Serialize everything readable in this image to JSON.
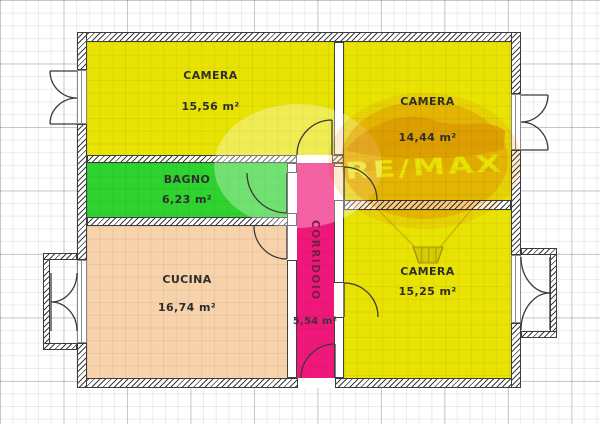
{
  "watermark": {
    "brand": "RE/MAX"
  },
  "rooms": {
    "camera1": {
      "label": "CAMERA",
      "area": "15,56 m²",
      "color": "#e9e304"
    },
    "camera2": {
      "label": "CAMERA",
      "area": "14,44 m²",
      "color": "#e9e304"
    },
    "camera3": {
      "label": "CAMERA",
      "area": "15,25 m²",
      "color": "#e9e304"
    },
    "bagno": {
      "label": "BAGNO",
      "area": "6,23 m²",
      "color": "#2fd32f"
    },
    "cucina": {
      "label": "CUCINA",
      "area": "16,74 m²",
      "color": "#f7d2ab"
    },
    "corridoio": {
      "label": "CORRIDOIO",
      "area": "5,54 m²",
      "color": "#ef187a"
    }
  },
  "colors": {
    "wall_outline": "#3c3c3c",
    "balloon_orange": "#f5a21b",
    "balloon_band": "#e77b00"
  }
}
